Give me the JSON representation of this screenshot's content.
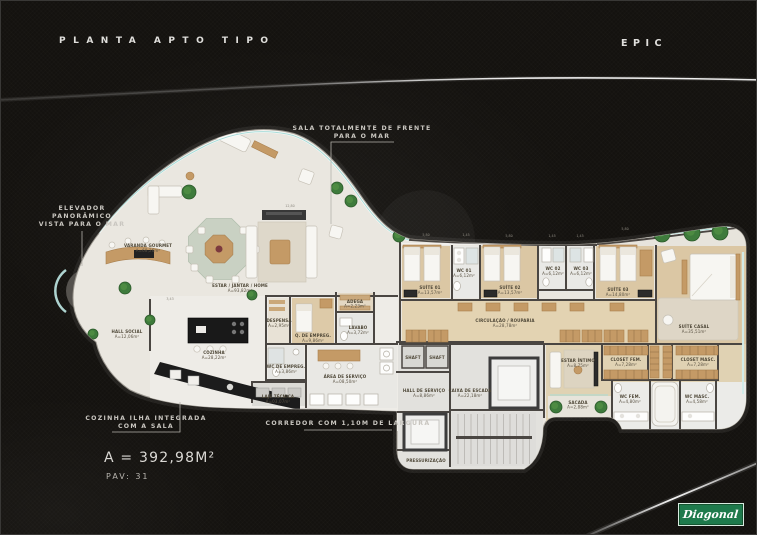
{
  "header": {
    "title_left": "PLANTA APTO TIPO",
    "title_right": "EPIC"
  },
  "callouts": {
    "elevador": {
      "line1": "ELEVADOR",
      "line2": "PANORÂMICO",
      "line3": "VISTA PARA O MAR"
    },
    "sala": {
      "line1": "SALA TOTALMENTE DE FRENTE",
      "line2": "PARA O MAR"
    },
    "cozinha": {
      "line1": "COZINHA ILHA INTEGRADA",
      "line2": "COM A SALA"
    },
    "corredor": {
      "text": "CORREDOR COM 1,10M DE LARGURA"
    }
  },
  "summary": {
    "total_area": "A = 392,98M²",
    "floor": "PAV: 31"
  },
  "logo": {
    "brand": "Diagonal"
  },
  "colors": {
    "background": "#14120f",
    "plan_floor": "#eae7e0",
    "wood_floor": "#dbc7a4",
    "wall": "#4a4642",
    "tree_green": "#3e7b3c",
    "glass": "#a8dcd8",
    "counter_black": "#1b1b1b",
    "logo_green": "#1e7a4c",
    "swoosh": "#ffffff"
  },
  "floorplan": {
    "rooms": {
      "varanda_gourmet": {
        "name": "VARANDA GOURMET",
        "area": "A=68,26m²"
      },
      "estar_jantar_home": {
        "name": "ESTAR / JANTAR / HOME",
        "area": "A=93,82m²"
      },
      "hall_social": {
        "name": "HALL SOCIAL",
        "area": "A=12,06m²"
      },
      "cozinha": {
        "name": "COZINHA",
        "area": "A=28,22m²"
      },
      "despensa": {
        "name": "DESPENSA",
        "area": "A=2,95m²"
      },
      "q_de_empreg": {
        "name": "Q. DE EMPREG.",
        "area": "A=9,86m²"
      },
      "wc_de_empreg": {
        "name": "WC DE EMPREG.",
        "area": "A=3,86m²"
      },
      "lavabo": {
        "name": "LAVABO",
        "area": "A=3,72m²"
      },
      "adega": {
        "name": "ADEGA",
        "area": "A=2,23m²"
      },
      "area_de_servico": {
        "name": "ÁREA DE SERVIÇO",
        "area": "A=08,50m²"
      },
      "laje_tecnica": {
        "name": "LAJE TÉCNICA",
        "area": "A=03,07m²"
      },
      "suite_01": {
        "name": "SUÍTE 01",
        "area": "A=13,57m²"
      },
      "wc_01": {
        "name": "WC 01",
        "area": "A=6,12m²"
      },
      "suite_02": {
        "name": "SUÍTE 02",
        "area": "A=13,57m²"
      },
      "wc_02": {
        "name": "WC 02",
        "area": "A=6,12m²"
      },
      "wc_03": {
        "name": "WC 03",
        "area": "A=6,12m²"
      },
      "suite_03": {
        "name": "SUÍTE 03",
        "area": "A=14,80m²"
      },
      "suite_casal": {
        "name": "SUÍTE CASAL",
        "area": "A=35,51m²"
      },
      "sacada": {
        "name": "SACADA",
        "area": "A=07,35m²"
      },
      "circulacao_rouparia": {
        "name": "CIRCULAÇÃO / ROUPARIA",
        "area": "A=28,78m²"
      },
      "shaft_1": {
        "name": "SHAFT"
      },
      "shaft_2": {
        "name": "SHAFT"
      },
      "hall_de_servico": {
        "name": "HALL DE SERVIÇO",
        "area": "A=8,86m²"
      },
      "caixa_de_escada": {
        "name": "CAIXA DE ESCADA",
        "area": "A=22,18m²"
      },
      "pressurizacao": {
        "name": "PRESSURIZAÇÃO"
      },
      "estar_intimo": {
        "name": "ESTAR ÍNTIMO",
        "area": "A=8,75m²"
      },
      "sacada_intima": {
        "name": "SACADA",
        "area": "A=2,88m²"
      },
      "closet_fem": {
        "name": "CLOSET FEM.",
        "area": "A=7,28m²"
      },
      "closet_masc": {
        "name": "CLOSET MASC.",
        "area": "A=7,28m²"
      },
      "wc_fem": {
        "name": "WC FEM.",
        "area": "A=4,80m²"
      },
      "wc_masc": {
        "name": "WC MASC.",
        "area": "A=4,58m²"
      }
    },
    "dimensions": [
      "5,80",
      "1,45",
      "5,80",
      "1,45",
      "1,45",
      "5,80",
      "12,80",
      "3,43"
    ]
  }
}
